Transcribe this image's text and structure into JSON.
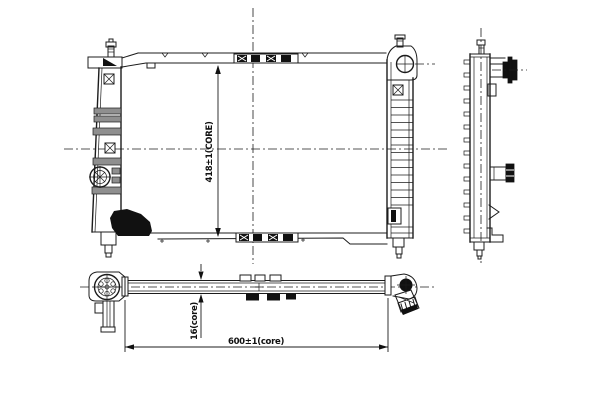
{
  "drawing": {
    "type": "technical-line-drawing",
    "subject": "radiator-three-view",
    "labels": {
      "core_height": "418±1(CORE)",
      "core_thickness": "16(core)",
      "core_width": "600±1(core)"
    },
    "colors": {
      "line": "#1c1c1c",
      "background": "#ffffff",
      "solid_fill": "#111111",
      "rib_gray": "#8f8f8f"
    }
  }
}
